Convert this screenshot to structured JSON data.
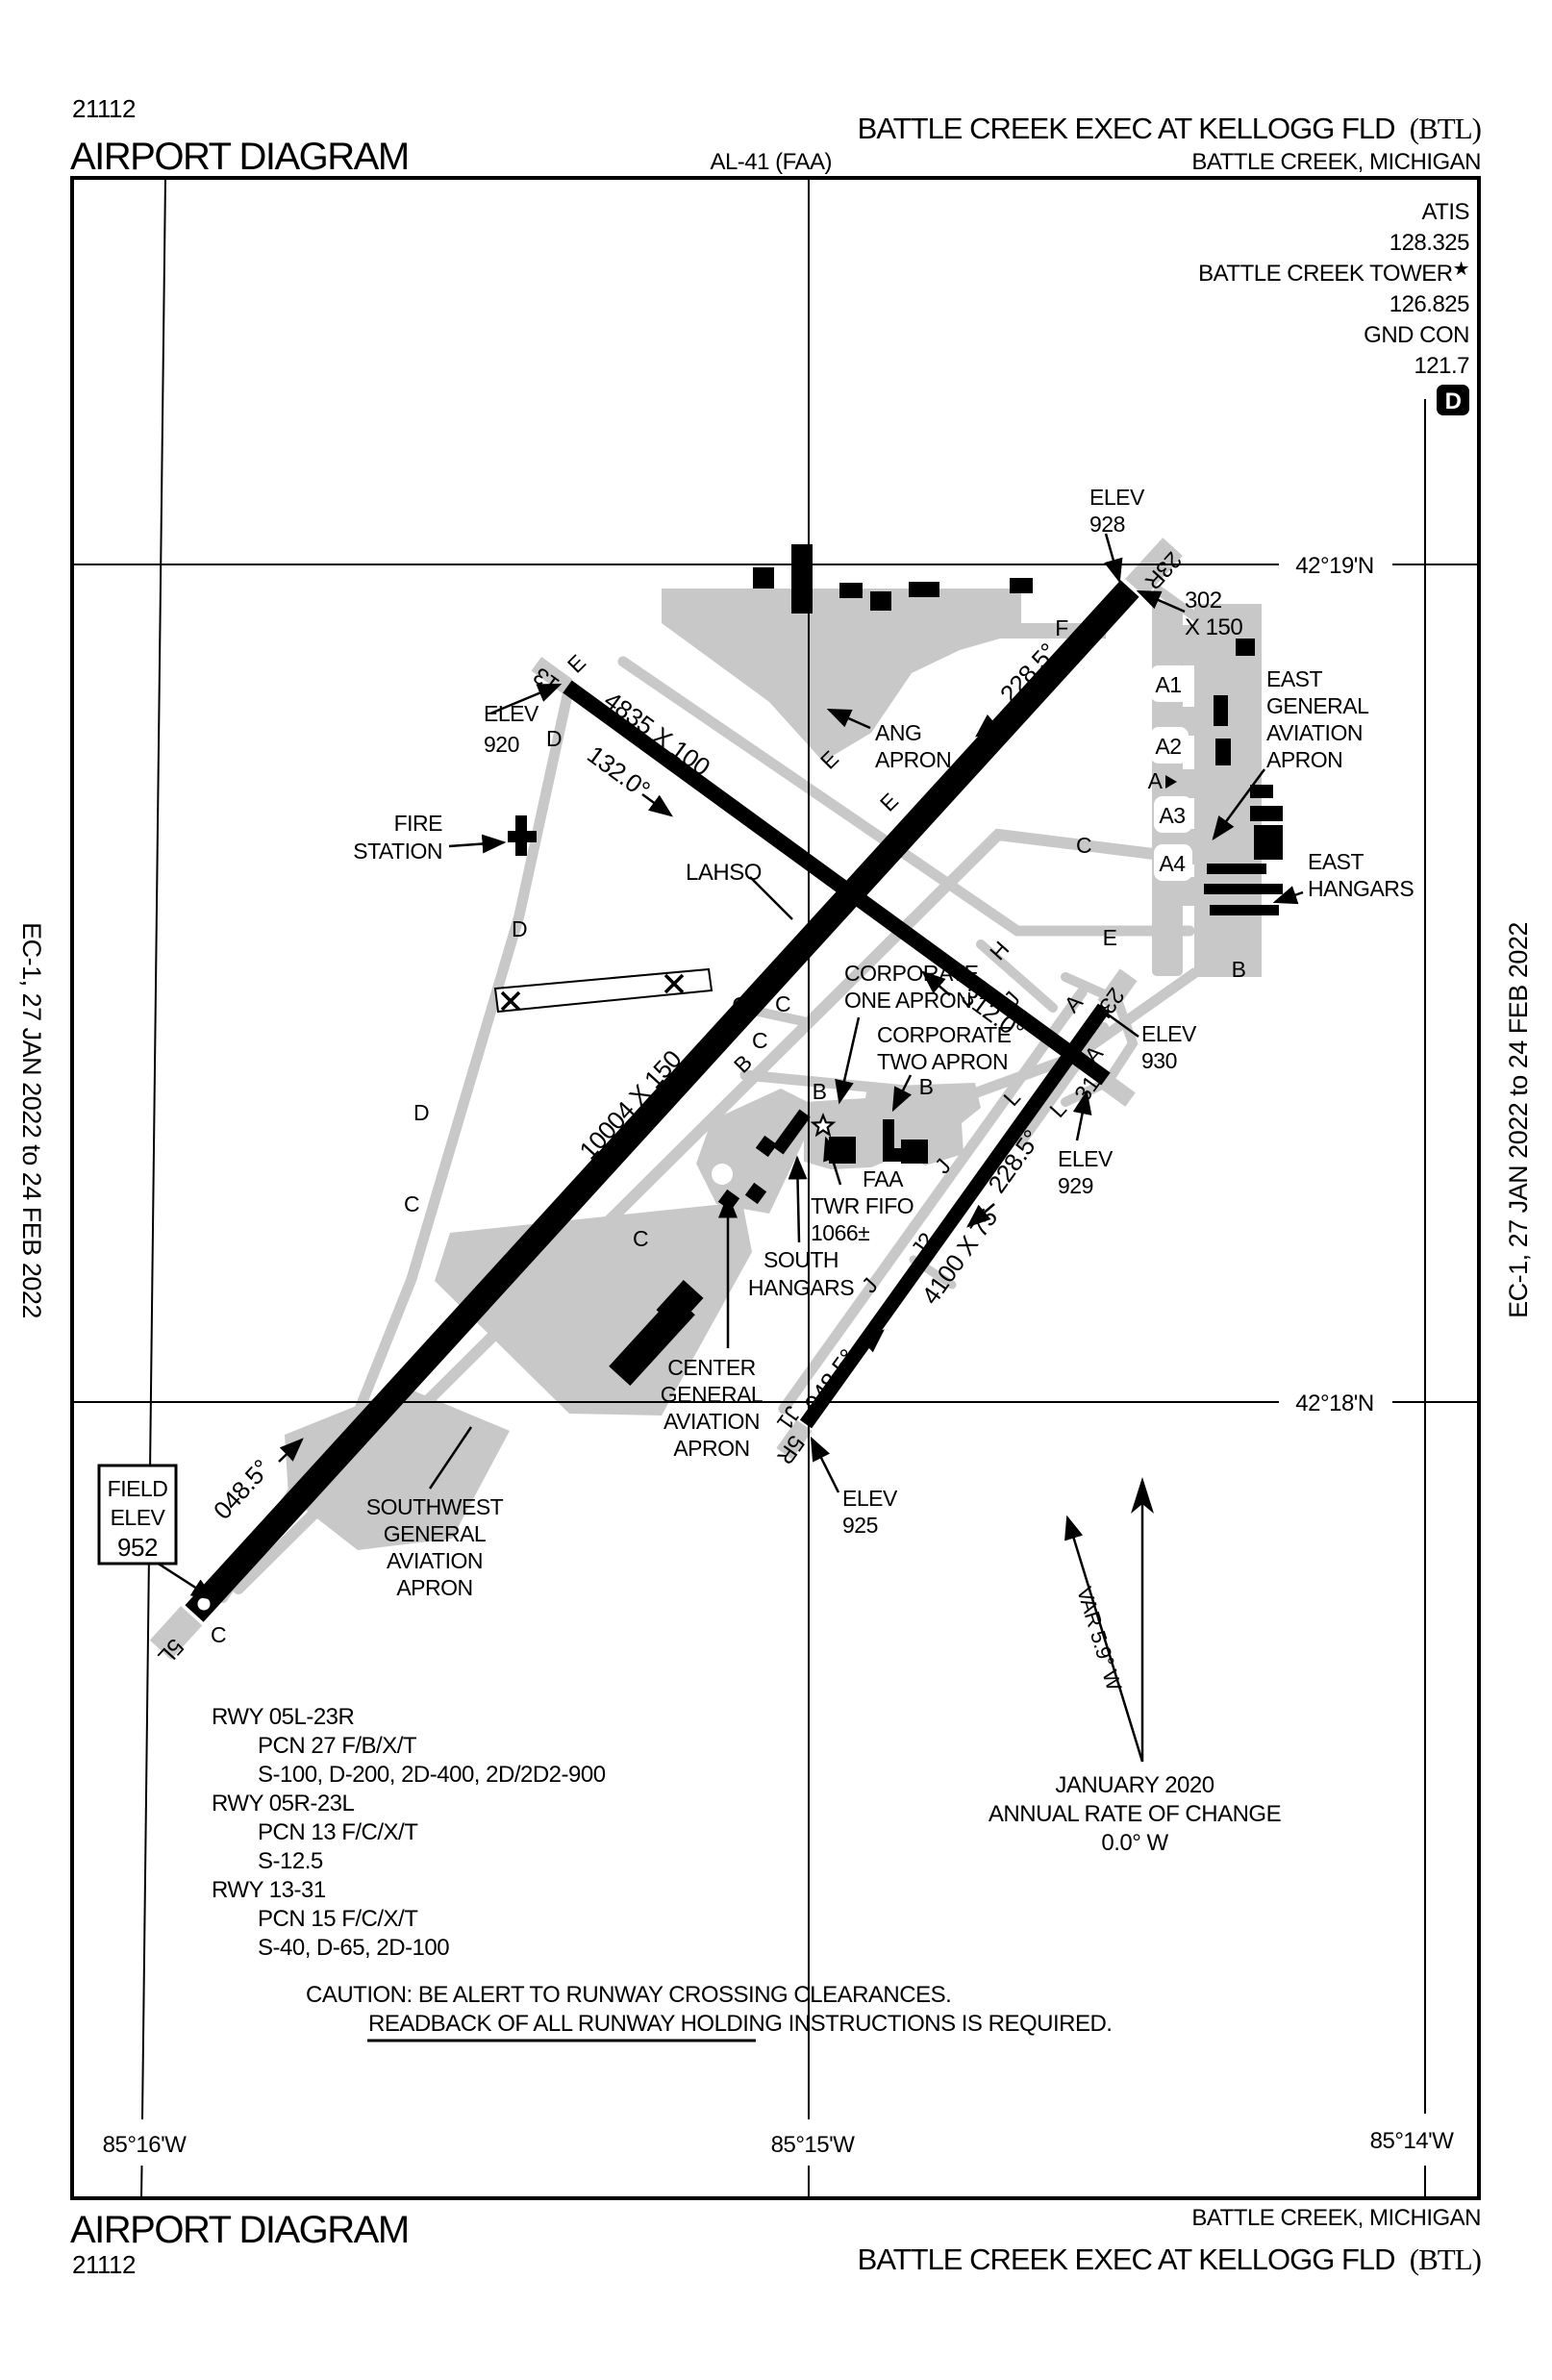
{
  "page": {
    "chart_id": "21112",
    "doc_title": "AIRPORT DIAGRAM",
    "chart_code": "AL-41 (FAA)",
    "airport": "BATTLE CREEK EXEC AT KELLOGG FLD",
    "ident": "(BTL)",
    "city": "BATTLE CREEK, MICHIGAN",
    "edition": "EC-1,  27 JAN 2022  to  24 FEB 2022"
  },
  "comms": {
    "atis_label": "ATIS",
    "atis_freq": "128.325",
    "tower_label": "BATTLE CREEK TOWER",
    "tower_star": "★",
    "tower_freq": "126.825",
    "gnd_label": "GND CON",
    "gnd_freq": "121.7",
    "d_icon": "D"
  },
  "grid": {
    "lat": [
      "42°19'N",
      "42°18'N"
    ],
    "lon": [
      "85°16'W",
      "85°15'W",
      "85°14'W"
    ]
  },
  "field_elev": [
    "FIELD",
    "ELEV",
    "952"
  ],
  "north": {
    "var_label": "VAR 5.9° W",
    "date": "JANUARY 2020",
    "rate": "ANNUAL RATE OF CHANGE",
    "value": "0.0° W"
  },
  "runways": {
    "main_dim": "10004 X 150",
    "r1331_dim": "4835 X 100",
    "r0523_dim": "4100 X 75",
    "disp": [
      "302",
      "X 150"
    ],
    "h132": "132.0°",
    "h312": "312.0°",
    "h228a": "228.5°",
    "h228b": "228.5°",
    "h048a": "048.5°",
    "h048b": "048.5°",
    "ends": {
      "r5l": "5L",
      "r5r": "5R",
      "r13": "13",
      "r31": "31",
      "r23l": "23L",
      "r23r": "23R"
    }
  },
  "elev": {
    "e920": [
      "ELEV",
      "920"
    ],
    "e925": [
      "ELEV",
      "925"
    ],
    "e928": [
      "ELEV",
      "928"
    ],
    "e929": [
      "ELEV",
      "929"
    ],
    "e930": [
      "ELEV",
      "930"
    ]
  },
  "labels": {
    "lahso": "LAHSO",
    "fire": [
      "FIRE",
      "STATION"
    ],
    "ang": [
      "ANG",
      "APRON"
    ],
    "east_ga": [
      "EAST",
      "GENERAL",
      "AVIATION",
      "APRON"
    ],
    "east_hangars": [
      "EAST",
      "HANGARS"
    ],
    "corp1": [
      "CORPORATE",
      "ONE APRON"
    ],
    "corp2": [
      "CORPORATE",
      "TWO APRON"
    ],
    "faa_twr": [
      "FAA",
      "TWR FIFO",
      "1066±"
    ],
    "south_hangars": [
      "SOUTH",
      "HANGARS"
    ],
    "center_ga": [
      "CENTER",
      "GENERAL",
      "AVIATION",
      "APRON"
    ],
    "sw_ga": [
      "SOUTHWEST",
      "GENERAL",
      "AVIATION",
      "APRON"
    ]
  },
  "twy": {
    "a": "A",
    "a1": "A1",
    "a2": "A2",
    "a3": "A3",
    "a4": "A4",
    "b": "B",
    "c": "C",
    "d": "D",
    "e": "E",
    "f": "F",
    "g": "G",
    "h": "H",
    "j": "J",
    "j1": "J1",
    "j2": "J2",
    "l": "L"
  },
  "rwy_data": {
    "r1_title": "RWY 05L-23R",
    "r1_pcn": "PCN 27 F/B/X/T",
    "r1_str": "S-100, D-200, 2D-400, 2D/2D2-900",
    "r2_title": "RWY 05R-23L",
    "r2_pcn": "PCN 13 F/C/X/T",
    "r2_str": "S-12.5",
    "r3_title": "RWY 13-31",
    "r3_pcn": "PCN 15 F/C/X/T",
    "r3_str": "S-40, D-65, 2D-100"
  },
  "caution": {
    "line1": "CAUTION: BE ALERT TO RUNWAY CROSSING CLEARANCES.",
    "line2": "READBACK OF ALL RUNWAY HOLDING INSTRUCTIONS IS REQUIRED."
  }
}
